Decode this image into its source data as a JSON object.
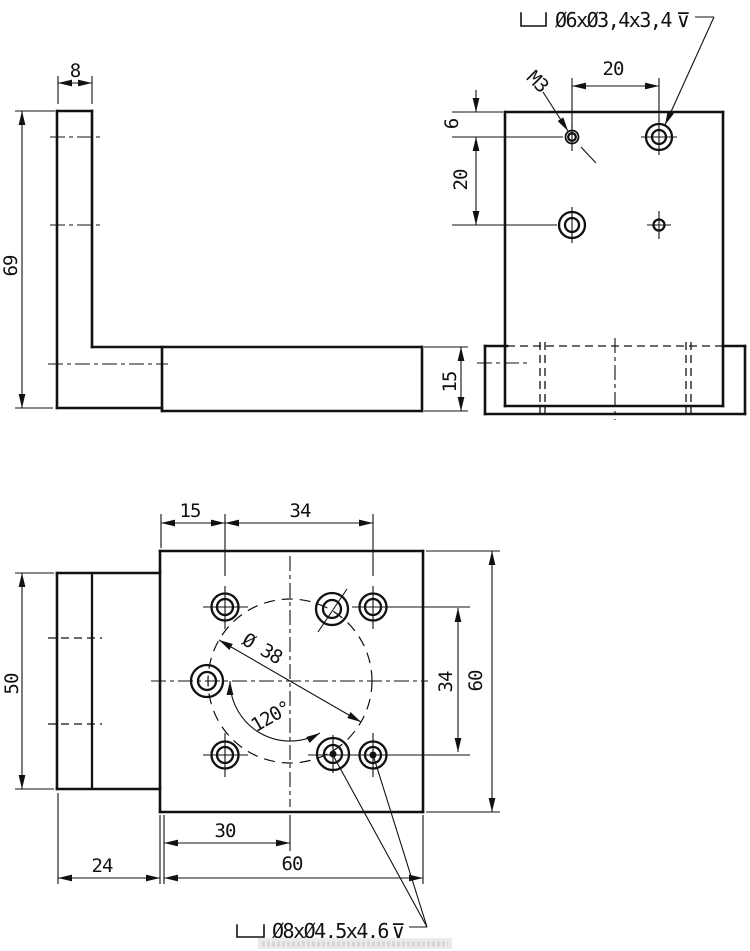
{
  "side_view": {
    "thickness": "8",
    "height": "69",
    "base_height": "15"
  },
  "front_view": {
    "counterbore_note": "Ø6xØ3,4x3,4",
    "depth_symbol": "⊽",
    "thread_label": "M3",
    "top_offset": "6",
    "row_spacing": "20",
    "col_spacing": "20"
  },
  "plan_view": {
    "edge_offset": "15",
    "hole_spacing_top": "34",
    "flange_width": "50",
    "hole_spacing_right": "34",
    "plate_size_right": "60",
    "half_width": "30",
    "flange_depth": "24",
    "plate_size_bottom": "60",
    "bolt_circle_dia": "Ø 38",
    "hole_angle": "120°",
    "counterbore_note": "Ø8xØ4,5x4,6",
    "depth_symbol": "⊽"
  }
}
